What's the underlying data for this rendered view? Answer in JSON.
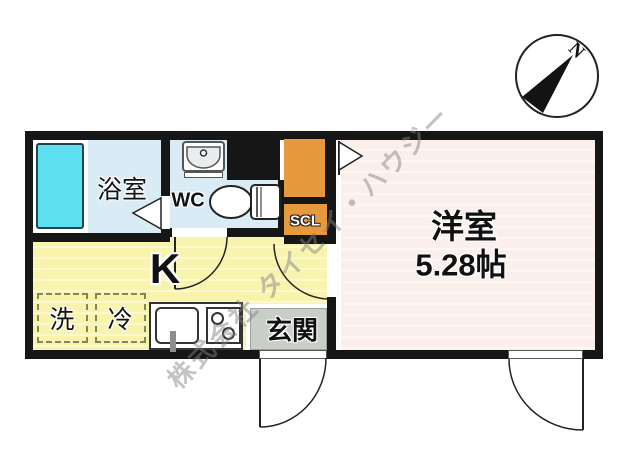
{
  "watermark": "株式会社 タイセイ・ハウジー",
  "compass": {
    "north_label": "N"
  },
  "rooms": {
    "bathroom": {
      "label": "浴室"
    },
    "toilet": {
      "label": "WC"
    },
    "shoe_closet": {
      "label": "SCL"
    },
    "kitchen": {
      "label": "K"
    },
    "washer": {
      "label": "洗"
    },
    "fridge": {
      "label": "冷"
    },
    "entrance": {
      "label": "玄関"
    },
    "western_room": {
      "label": "洋室",
      "area": "5.28帖"
    }
  },
  "colors": {
    "wall": "#161616",
    "bath_floor": "#d9ecf5",
    "bathtub": "#5ee0f0",
    "kitchen_floor": "#f8f4ae",
    "western_floor": "#fbefec",
    "closet_orange": "#e79a3d",
    "entrance_gray": "#c7cfc7"
  }
}
